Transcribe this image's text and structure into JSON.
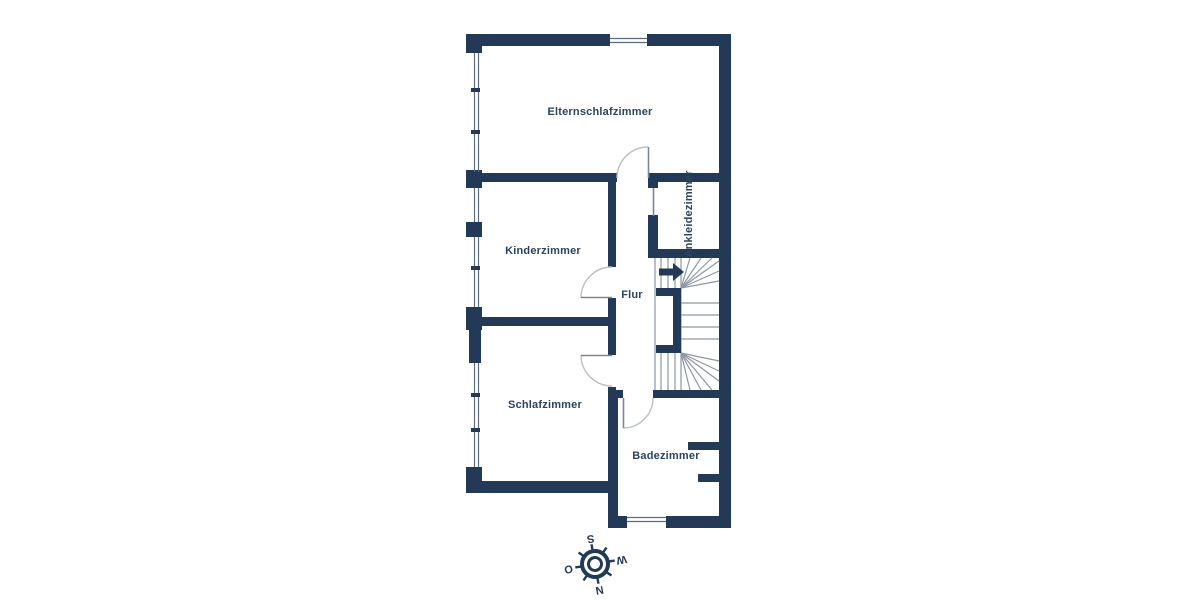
{
  "rooms": {
    "master_bedroom": "Elternschlafzimmer",
    "kids_room": "Kinderzimmer",
    "hallway": "Flur",
    "dressing_room": "Ankleidezimmer",
    "bedroom": "Schlafzimmer",
    "bathroom": "Badezimmer"
  },
  "compass": {
    "north": "N",
    "south": "S",
    "east": "O",
    "west": "W",
    "rotation_deg": 170
  },
  "colors": {
    "wall": "#223a58",
    "label": "#2d4360",
    "stair_line": "#8d97a3",
    "door_arc": "#b9bfc7",
    "door_leaf": "#7a8694",
    "background": "#ffffff"
  }
}
